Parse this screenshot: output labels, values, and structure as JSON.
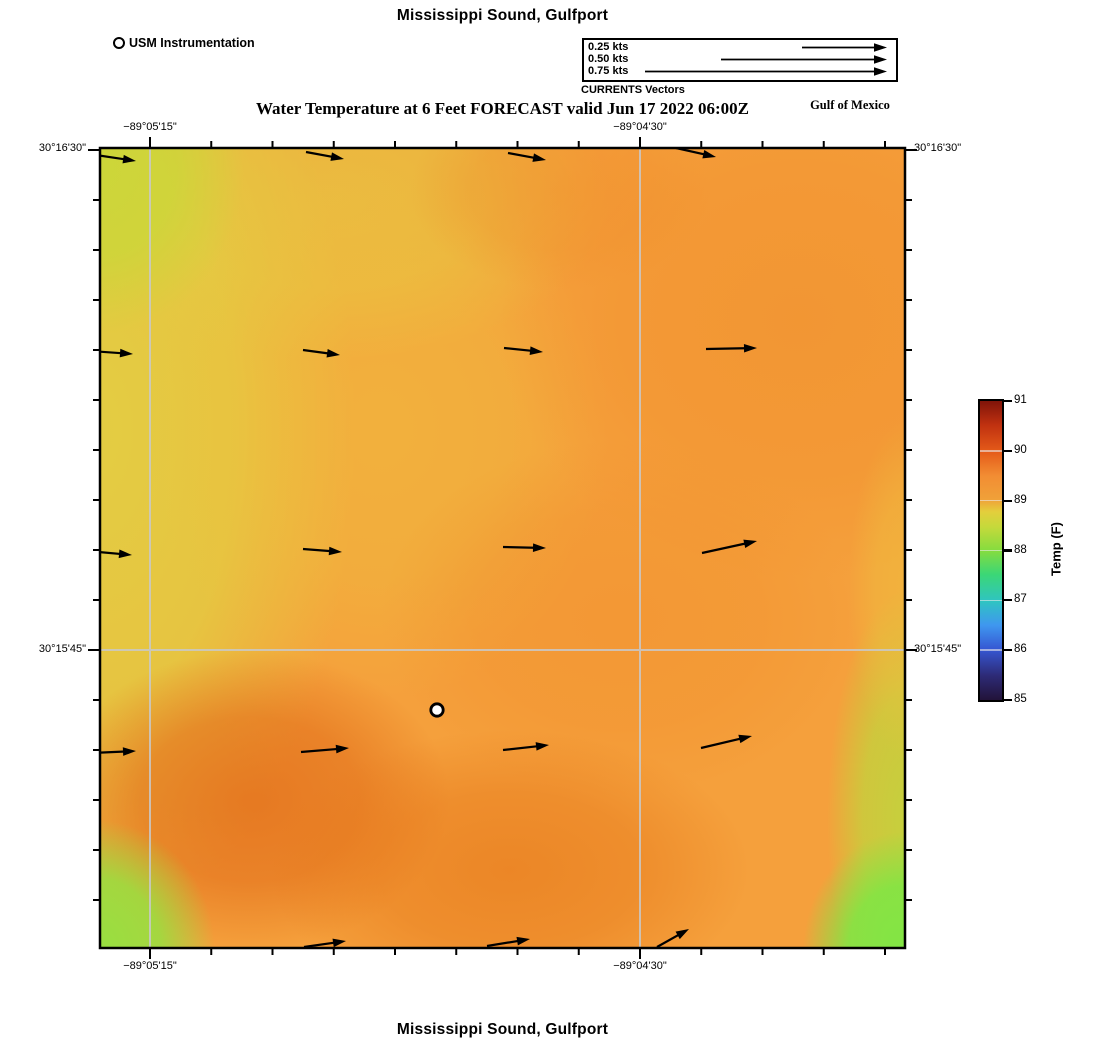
{
  "header": {
    "top_title": "Mississippi Sound, Gulfport",
    "subtitle": "Water Temperature at 6 Feet FORECAST valid Jun 17 2022 06:00Z",
    "region_label": "Gulf of Mexico",
    "bottom_title": "Mississippi Sound, Gulfport"
  },
  "usm_legend": {
    "label": "USM Instrumentation",
    "marker": "open-circle"
  },
  "vector_legend": {
    "caption": "CURRENTS Vectors",
    "rows": [
      {
        "label": "0.25 kts",
        "length_px": 85
      },
      {
        "label": "0.50 kts",
        "length_px": 166
      },
      {
        "label": "0.75 kts",
        "length_px": 242
      }
    ]
  },
  "axes": {
    "top": [
      "−89°05'15\"",
      "−89°04'30\""
    ],
    "bottom": [
      "−89°05'15\"",
      "−89°04'30\""
    ],
    "left": [
      "30°16'30\"",
      "30°15'45\""
    ],
    "right": [
      "30°16'30\"",
      "30°15'45\""
    ]
  },
  "colorbar": {
    "title": "Temp (F)",
    "min": 85,
    "max": 91,
    "ticks": [
      85,
      86,
      87,
      88,
      89,
      90,
      91
    ],
    "stops": [
      [
        0,
        "#221339"
      ],
      [
        8,
        "#2d2a75"
      ],
      [
        17,
        "#3657d3"
      ],
      [
        25,
        "#3f97ef"
      ],
      [
        33,
        "#2fc4c2"
      ],
      [
        42,
        "#3bd776"
      ],
      [
        50,
        "#85dc3f"
      ],
      [
        58,
        "#c6d93b"
      ],
      [
        63,
        "#e4ce3c"
      ],
      [
        67,
        "#f0a139"
      ],
      [
        75,
        "#f28d33"
      ],
      [
        83,
        "#e55b19"
      ],
      [
        92,
        "#c03110"
      ],
      [
        100,
        "#801409"
      ]
    ]
  },
  "chart_data": {
    "type": "heatmap",
    "site": "Mississippi Sound, Gulfport",
    "title": "Water Temperature at 6 Feet FORECAST valid Jun 17 2022 06:00Z",
    "variable": "Temp (F)",
    "scale_range": [
      85,
      91
    ],
    "displayed_temp_range_f": [
      87.8,
      89.9
    ],
    "lon_tick_labels": [
      "−89°05'15\"",
      "−89°04'30\""
    ],
    "lat_tick_labels": [
      "30°16'30\"",
      "30°15'45\""
    ],
    "field_summary": "Mostly ~89F orange; yellow-green band on west edge, bright green in SW and SE corners, warmer ~89.8F patches in south-central and northeast areas",
    "coords": "page_px",
    "current_vectors": [
      [
        96,
        155,
        136,
        161
      ],
      [
        306,
        152,
        344,
        159
      ],
      [
        508,
        153,
        546,
        160
      ],
      [
        676,
        148,
        716,
        157
      ],
      [
        90,
        351,
        133,
        354
      ],
      [
        303,
        350,
        340,
        355
      ],
      [
        504,
        348,
        543,
        352
      ],
      [
        706,
        349,
        757,
        348
      ],
      [
        88,
        551,
        132,
        555
      ],
      [
        303,
        549,
        342,
        552
      ],
      [
        503,
        547,
        546,
        548
      ],
      [
        702,
        553,
        757,
        541
      ],
      [
        92,
        753,
        136,
        751
      ],
      [
        301,
        752,
        349,
        748
      ],
      [
        503,
        750,
        549,
        745
      ],
      [
        701,
        748,
        752,
        736
      ],
      [
        304,
        947,
        346,
        941
      ],
      [
        487,
        946,
        530,
        939
      ],
      [
        657,
        947,
        689,
        929
      ]
    ],
    "instrument_marker": {
      "x": 437,
      "y": 710,
      "label": "USM Instrumentation"
    },
    "grid": {
      "vertical_x": [
        150,
        640
      ],
      "horizontal_y": [
        650
      ]
    },
    "base_color": "#F5A03C"
  }
}
